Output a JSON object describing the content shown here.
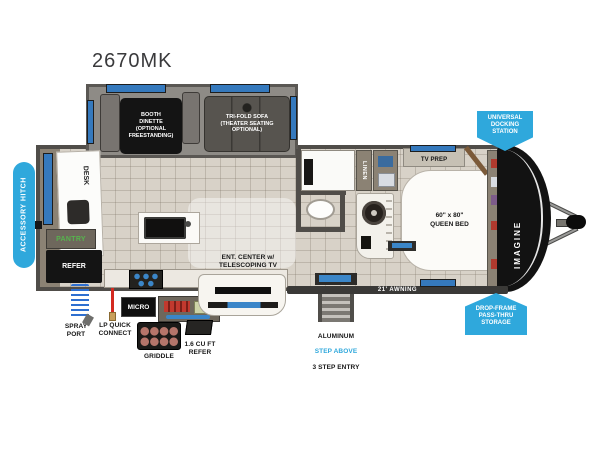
{
  "title": "2670MK",
  "colors": {
    "badge_blue": "#2fa8dc",
    "window_blue": "#3579bd",
    "wall_dark": "#504d49",
    "floor_tile": "#d8d2c8",
    "cap_black": "#121212",
    "pantry_green": "#56b44d"
  },
  "callouts": {
    "accessory_hitch": "ACCESSORY HITCH",
    "universal_docking_station": "UNIVERSAL\nDOCKING\nSTATION",
    "drop_frame_storage": "DROP-FRAME\nPASS-THRU\nSTORAGE"
  },
  "rooms": {
    "booth_dinette": "BOOTH\nDINETTE\n(OPTIONAL\nFREESTANDING)",
    "tri_fold_sofa": "TRI-FOLD SOFA\n(THEATER SEATING OPTIONAL)",
    "desk": "DESK",
    "pantry": "PANTRY",
    "refer": "REFER",
    "linen": "LINEN",
    "tv_prep": "TV PREP",
    "queen_bed": "60\" x 80\"\nQUEEN BED",
    "ent_center": "ENT. CENTER w/\nTELESCOPING TV",
    "micro": "MICRO",
    "griddle": "GRIDDLE",
    "outdoor_refer": "1.6 CU FT\nREFER"
  },
  "exterior": {
    "awning": "21' AWNING",
    "spray_port": "SPRAY\nPORT",
    "lp_quick_connect": "LP QUICK\nCONNECT",
    "entry_step_line1": "ALUMINUM",
    "entry_step_line2": "STEP ABOVE",
    "entry_step_line3": "3 STEP ENTRY",
    "brand": "IMAGINE"
  }
}
